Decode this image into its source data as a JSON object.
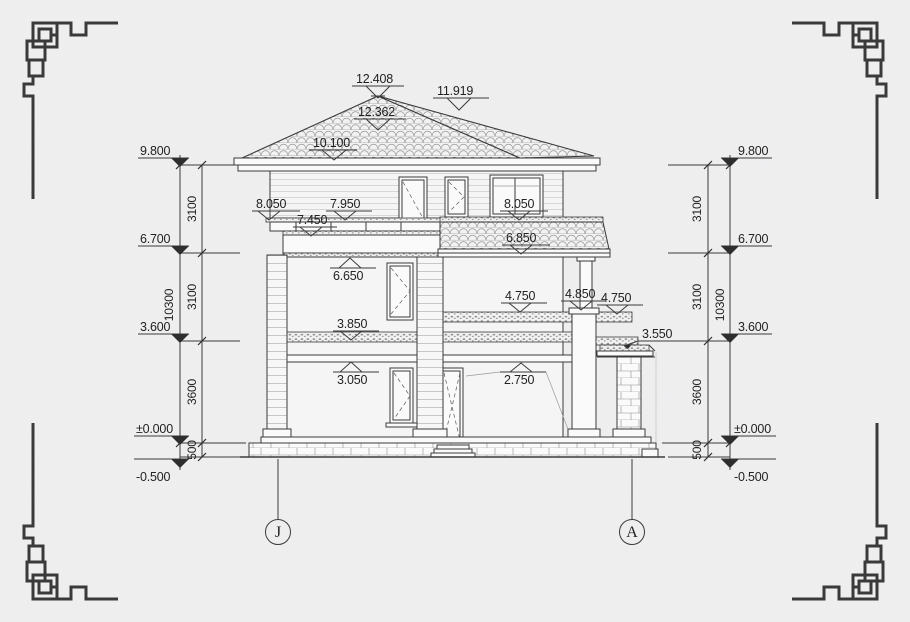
{
  "drawing": {
    "background": "#f0f0f1",
    "ink": "#3b3b3b",
    "type": "house-side-elevation"
  },
  "roof_marks": {
    "peak": "12.408",
    "ridge": "11.919",
    "peak_under": "12.362",
    "eave": "10.100"
  },
  "facade_marks": {
    "parapet_left": "8.050",
    "rail_top": "7.950",
    "rail_bottom": "7.450",
    "parapet_right": "8.050",
    "pent_roof": "6.850",
    "balcony_slab_bottom": "6.650",
    "terrace_slab_left": "4.750",
    "column_top": "4.850",
    "terrace_slab_right": "4.750",
    "porch_roof": "3.550",
    "floor_band_top": "3.850",
    "floor_band_bottom": "3.050",
    "door_head": "2.750"
  },
  "left_dimensions": {
    "levels": [
      "9.800",
      "6.700",
      "3.600",
      "±0.000",
      "-0.500"
    ],
    "segments": [
      "3100",
      "3100",
      "3600",
      "500"
    ],
    "overall": "10300"
  },
  "right_dimensions": {
    "levels": [
      "9.800",
      "6.700",
      "3.600",
      "±0.000",
      "-0.500"
    ],
    "segments": [
      "3100",
      "3100",
      "3600",
      "500"
    ],
    "overall": "10300"
  },
  "grid": {
    "left_bubble": "J",
    "right_bubble": "A"
  }
}
